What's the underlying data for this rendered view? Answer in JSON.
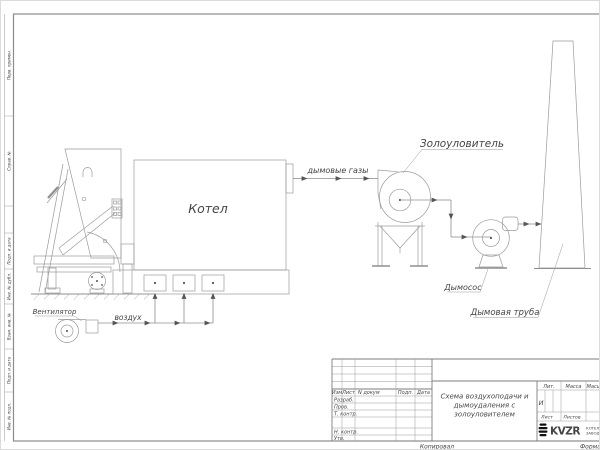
{
  "colors": {
    "line": "#9b9b9b",
    "text": "#454545",
    "frame": "#8c8c8c",
    "arrow": "#555555",
    "logo": "#111111"
  },
  "schematic": {
    "boiler_label": "Котел",
    "fan_label": "Вентилятор",
    "air_label": "воздух",
    "flue_gas_label": "дымовые газы",
    "ash_collector_label": "Золоуловитель",
    "smoke_exhauster_label": "Дымосос",
    "chimney_label": "Дымовая труба"
  },
  "margin": {
    "labels": [
      "Перв. примен.",
      "Справ. №",
      "Подп. и дата",
      "Инв. № дубл.",
      "Взам. инв. №",
      "Подп. и дата",
      "Инв. № подл."
    ]
  },
  "title_block": {
    "title_line1": "Схема воздухоподачи и",
    "title_line2": "дымоудаления с",
    "title_line3": "золоуловителем",
    "col_izm": "Изм",
    "col_list": "Лист",
    "col_doc": "N докум",
    "col_podp": "Подп.",
    "col_data": "Дата",
    "row_razrab": "Разраб.",
    "row_prov": "Пров.",
    "row_tkontr": "Т. контр.",
    "row_nkontr": "Н. контр.",
    "row_utv": "Утв.",
    "lit_header": "Лит.",
    "massa_header": "Масса",
    "scale_header": "Масш",
    "lit_value": "И",
    "list_label": "Лист",
    "listov_label": "Листов",
    "logo_text": "KVZR",
    "company_line1": "КОТЕЛЬ",
    "company_line2": "ЗАВОД"
  },
  "footer": {
    "copied_label": "Копировал",
    "format_label": "Формат"
  }
}
